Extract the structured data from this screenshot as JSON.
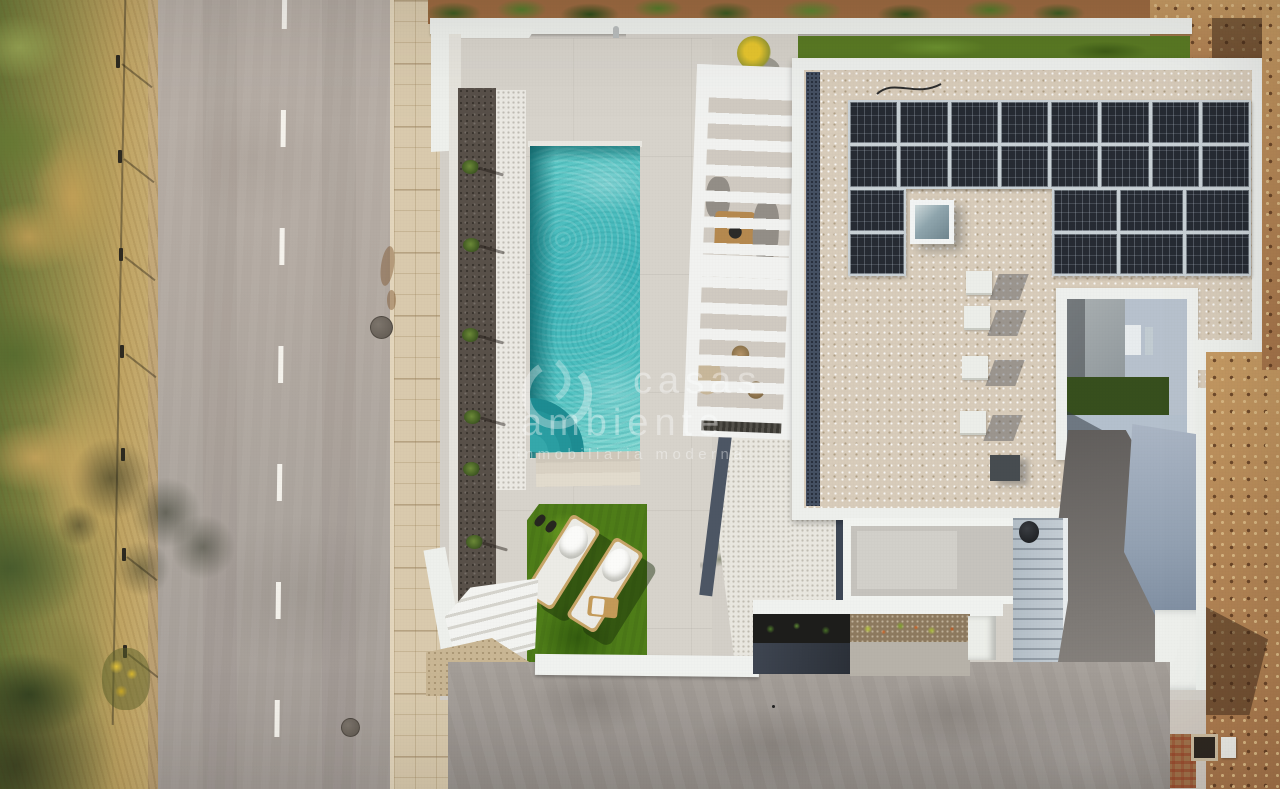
{
  "scene": {
    "description": "Aerial top-down drone photo of a modern white villa: rectangular turquoise pool with corner steps, louvered pergola over a dining terrace, flat gravel roof with solar panels and skylight, bright artificial lawn with two sun loungers, dark driveway, asphalt road with dashed center line and sidewalk on the left, wild vegetation strip and bare dirt plots around",
    "view": "top-down aerial, daytime"
  },
  "watermark": {
    "logo": "leaf-circle-logo",
    "line1": "casas",
    "line2": "ambiente",
    "tagline": "inmobiliaria moderna",
    "text_color": "#ffffff"
  },
  "objects": {
    "road": {
      "marking": "dashed white center line",
      "visible_dashes": 7,
      "manholes": 2
    },
    "pool": {
      "shape": "rectangular",
      "water_color": "#45bdc1",
      "corner_steps": 4,
      "wide_steps": 3
    },
    "solar_array": {
      "panel_count": 24,
      "panel_color": "#262b33",
      "blocks": [
        {
          "name": "top",
          "cols": 8,
          "rows": 2
        },
        {
          "name": "lower-left",
          "cols": 1,
          "rows": 2
        },
        {
          "name": "lower-right",
          "cols": 3,
          "rows": 2
        }
      ]
    },
    "skylight_count": 1,
    "ac_units": 4,
    "sun_loungers": 2,
    "flower_pots": {
      "count": 2,
      "flower_color": "#e6c52e"
    },
    "planter_shrubs": 6,
    "pergola": {
      "type": "white louvered slat roof",
      "sections": 2
    },
    "dining_table_color": "#b5894f"
  },
  "palette": {
    "road_asphalt": "#b4aba3",
    "sidewalk": "#d9caad",
    "vegetation_green": "#6d8038",
    "dry_grass": "#c9a85e",
    "deck_concrete": "#d6d2ca",
    "lawn_green": "#4e7d18",
    "pool_teal_dark": "#1f8f96",
    "pool_teal_light": "#8fdcd6",
    "white_structure": "#f0f2ef",
    "roof_gravel": "#d8ccba",
    "dark_gravel": "#57504a",
    "white_gravel": "#ebe9e3",
    "slate_paving": "#3f4652",
    "blue_wall": "#9aa7b8",
    "driveway": "#9a948e",
    "dirt_brown": "#b07f4e"
  }
}
